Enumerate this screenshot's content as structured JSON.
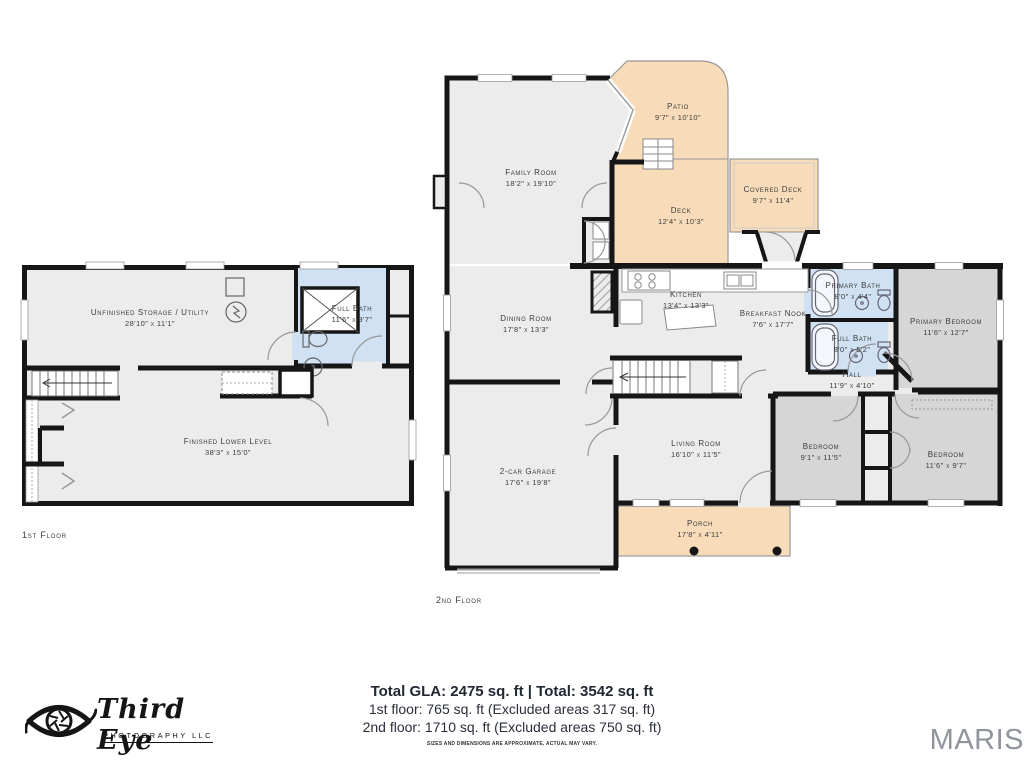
{
  "colors": {
    "wall": "#161616",
    "room_fill": "#ececec",
    "bedroom_fill": "#d6d6d6",
    "bath_fill": "#cfe1f3",
    "outdoor_fill": "#f8dcba",
    "maris_gray": "#8f949d"
  },
  "floor1": {
    "label": "1st Floor",
    "rooms": {
      "storage": {
        "name": "Unfinished Storage / Utility",
        "dims": "28'10\" x 11'1\""
      },
      "full_bath": {
        "name": "Full Bath",
        "dims": "11'6\" x 9'7\""
      },
      "lower_level": {
        "name": "Finished Lower Level",
        "dims": "38'3\" x 15'0\""
      }
    }
  },
  "floor2": {
    "label": "2nd Floor",
    "rooms": {
      "family": {
        "name": "Family Room",
        "dims": "18'2\" x 19'10\""
      },
      "patio": {
        "name": "Patio",
        "dims": "9'7\" x 10'10\""
      },
      "deck": {
        "name": "Deck",
        "dims": "12'4\" x 10'3\""
      },
      "covered_deck": {
        "name": "Covered Deck",
        "dims": "9'7\" x 11'4\""
      },
      "dining": {
        "name": "Dining Room",
        "dims": "17'8\" x 13'3\""
      },
      "kitchen": {
        "name": "Kitchen",
        "dims": "13'4\" x 13'3\""
      },
      "nook": {
        "name": "Breakfast Nook",
        "dims": "7'6\" x 17'7\""
      },
      "primary_bath": {
        "name": "Primary Bath",
        "dims": "8'0\" x 4'4\""
      },
      "full_bath": {
        "name": "Full Bath",
        "dims": "8'0\" x 5'2\""
      },
      "primary_bedroom": {
        "name": "Primary Bedroom",
        "dims": "11'6\" x 12'7\""
      },
      "hall": {
        "name": "Hall",
        "dims": "11'9\" x 4'10\""
      },
      "living": {
        "name": "Living Room",
        "dims": "16'10\" x 11'5\""
      },
      "garage": {
        "name": "2-car Garage",
        "dims": "17'6\" x 19'8\""
      },
      "bedroom1": {
        "name": "Bedroom",
        "dims": "9'1\" x 11'5\""
      },
      "bedroom2": {
        "name": "Bedroom",
        "dims": "11'6\" x 9'7\""
      },
      "porch": {
        "name": "Porch",
        "dims": "17'8\" x 4'11\""
      }
    }
  },
  "footer": {
    "total_line": "Total GLA: 2475 sq. ft | Total: 3542 sq. ft",
    "floor1_line": "1st floor: 765 sq. ft (Excluded areas 317 sq. ft)",
    "floor2_line": "2nd floor: 1710 sq. ft (Excluded areas 750 sq. ft)",
    "disclaimer": "SIZES AND DIMENSIONS ARE APPROXIMATE, ACTUAL MAY VARY."
  },
  "branding": {
    "photographer_script": "Third Eye",
    "photographer_sub": "PHOTOGRAPHY LLC",
    "mls": "MARIS"
  }
}
